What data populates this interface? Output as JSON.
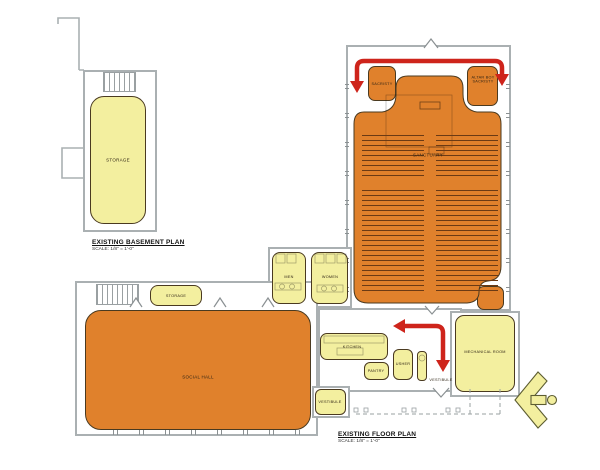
{
  "colors": {
    "orange": "#e0812c",
    "yellow": "#f3ef9f",
    "red": "#ce241b",
    "wall": "#aab0b2"
  },
  "basement": {
    "title": "EXISTING BASEMENT PLAN",
    "scale": "SCALE: 1/8\" = 1'-0\"",
    "rooms": {
      "storage": "STORAGE"
    }
  },
  "floor": {
    "title": "EXISTING FLOOR PLAN",
    "scale": "SCALE: 1/8\" = 1'-0\"",
    "rooms": {
      "sacristy": "SACRISTY",
      "altar_boy_sacristy": "ALTAR BOY SACRISTY",
      "sanctuary": "SANCTUARY",
      "men": "MEN",
      "women": "WOMEN",
      "storage": "STORAGE",
      "social_hall": "SOCIAL HALL",
      "kitchen": "KITCHEN",
      "pantry": "PANTRY",
      "usher": "USHER",
      "vestibule_main": "VESTIBULE",
      "vestibule_side": "VESTIBULE",
      "mechanical": "MECHANICAL ROOM"
    }
  }
}
